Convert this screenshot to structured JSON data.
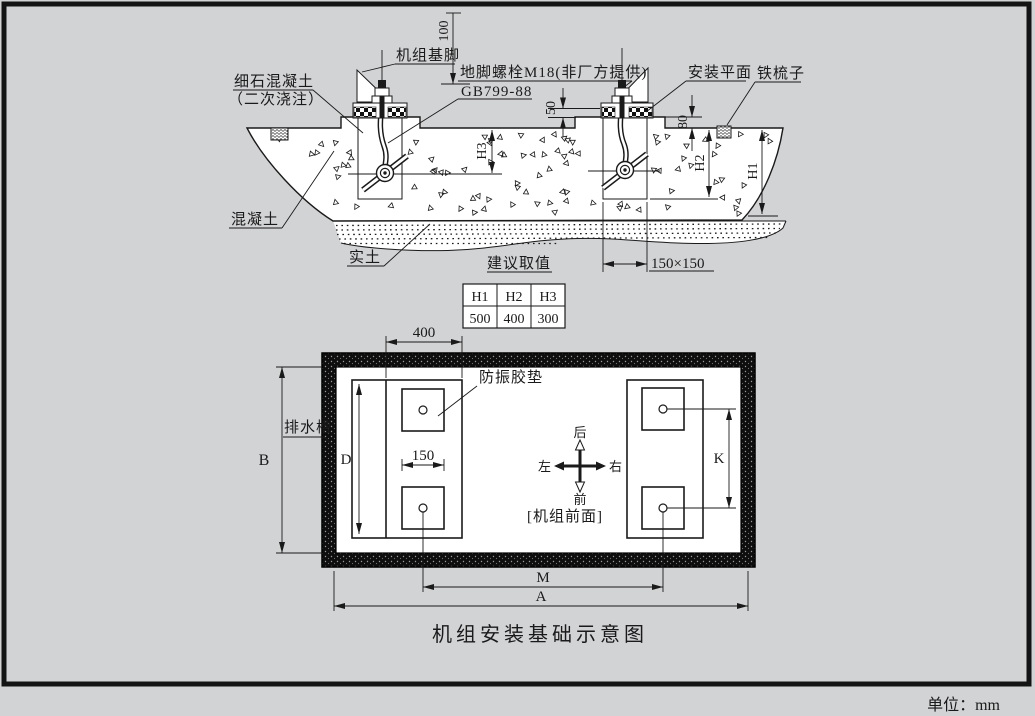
{
  "title": "机组安装基础示意图",
  "unit_note": "单位：mm",
  "colors": {
    "background": "#d2d3d5",
    "line": "#1a1a1a",
    "band": "#0e0e0e"
  },
  "section": {
    "labels": {
      "fine_concrete_1": "细石混凝土",
      "fine_concrete_2": "（二次浇注）",
      "machine_foot": "机组基脚",
      "anchor_bolt": "地脚螺栓M18(非厂方提供)",
      "bolt_standard": "GB799-88",
      "install_plane": "安装平面",
      "iron_comb": "铁梳子",
      "concrete": "混凝土",
      "solid_soil": "实土",
      "pocket_size": "150×150"
    },
    "dims": {
      "d100": "100",
      "d50": "50",
      "d80": "80",
      "dh3": "H3",
      "dh2": "H2",
      "dh1": "H1"
    }
  },
  "table": {
    "caption": "建议取值",
    "headers": [
      "H1",
      "H2",
      "H3"
    ],
    "values": [
      "500",
      "400",
      "300"
    ]
  },
  "plan": {
    "labels": {
      "pad": "防振胶垫",
      "drain": "排水槽",
      "front_face": "[机组前面]",
      "dir_back": "后",
      "dir_front": "前",
      "dir_left": "左",
      "dir_right": "右"
    },
    "dims": {
      "d400": "400",
      "d150": "150",
      "B": "B",
      "D": "D",
      "K": "K",
      "M": "M",
      "A": "A"
    }
  }
}
